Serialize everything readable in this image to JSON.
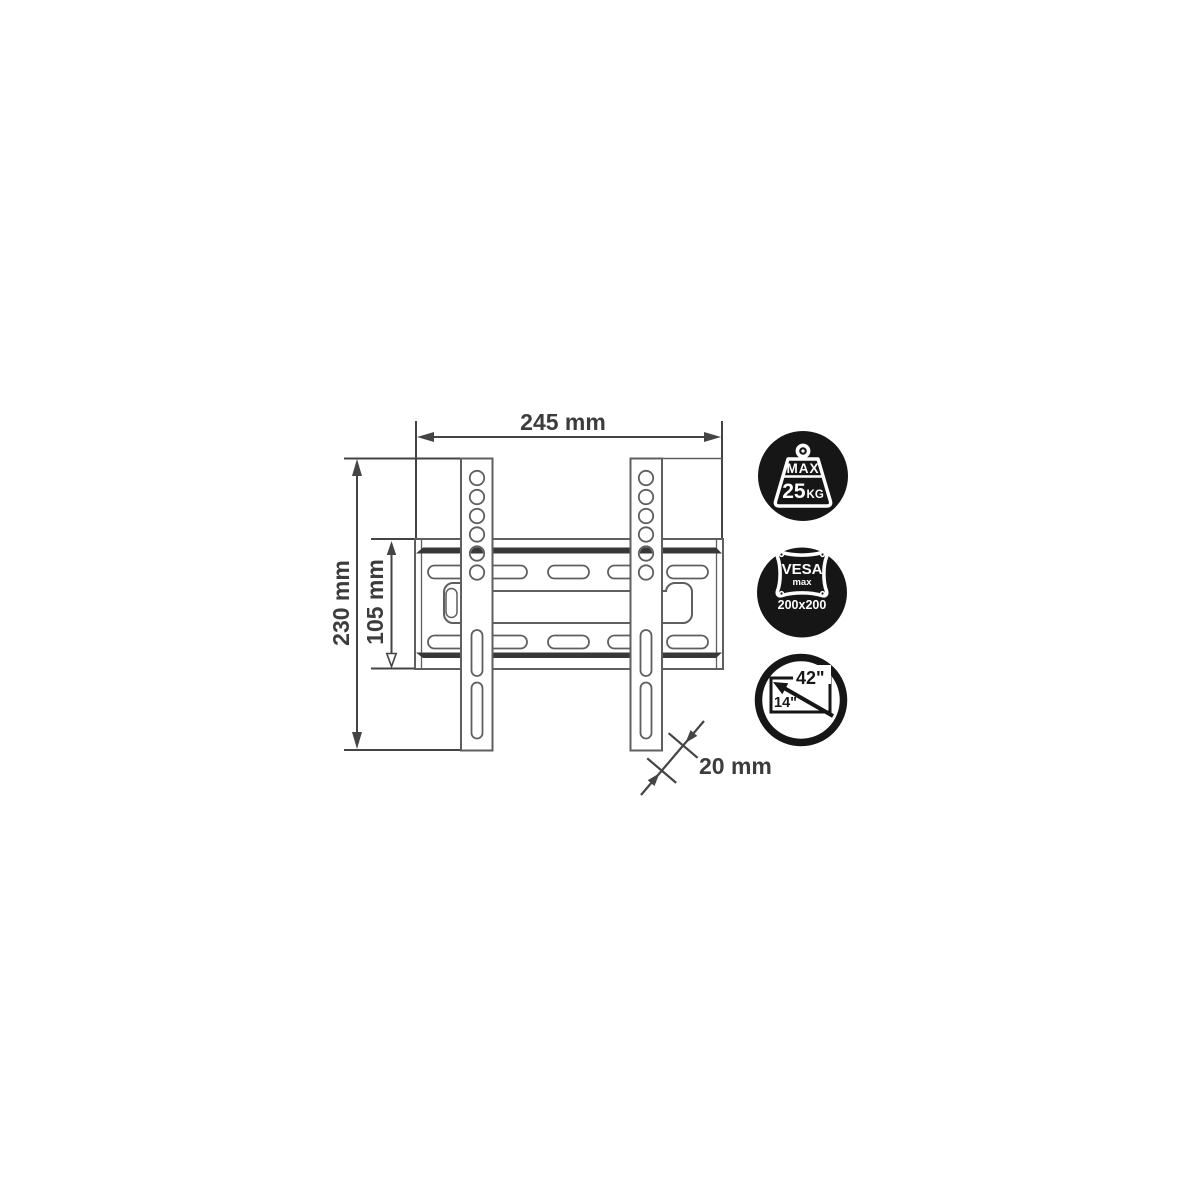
{
  "figure": {
    "background": "#ffffff",
    "line_color": "#5f5f5f",
    "stripe_color": "#383838",
    "dim_color": "#3c3c3c",
    "badge_bg": "#161616",
    "badge_fg": "#ffffff"
  },
  "dimension_labels": {
    "width": "245 mm",
    "height": "230 mm",
    "plate_height": "105 mm",
    "depth": "20 mm"
  },
  "badges": {
    "max_weight": {
      "label": "MAX",
      "value": "25",
      "unit": "KG"
    },
    "vesa": {
      "name": "VESA",
      "qualifier": "max",
      "pattern": "200x200"
    },
    "screen_size": {
      "max_size": "42\"",
      "min_size": "14\""
    }
  }
}
